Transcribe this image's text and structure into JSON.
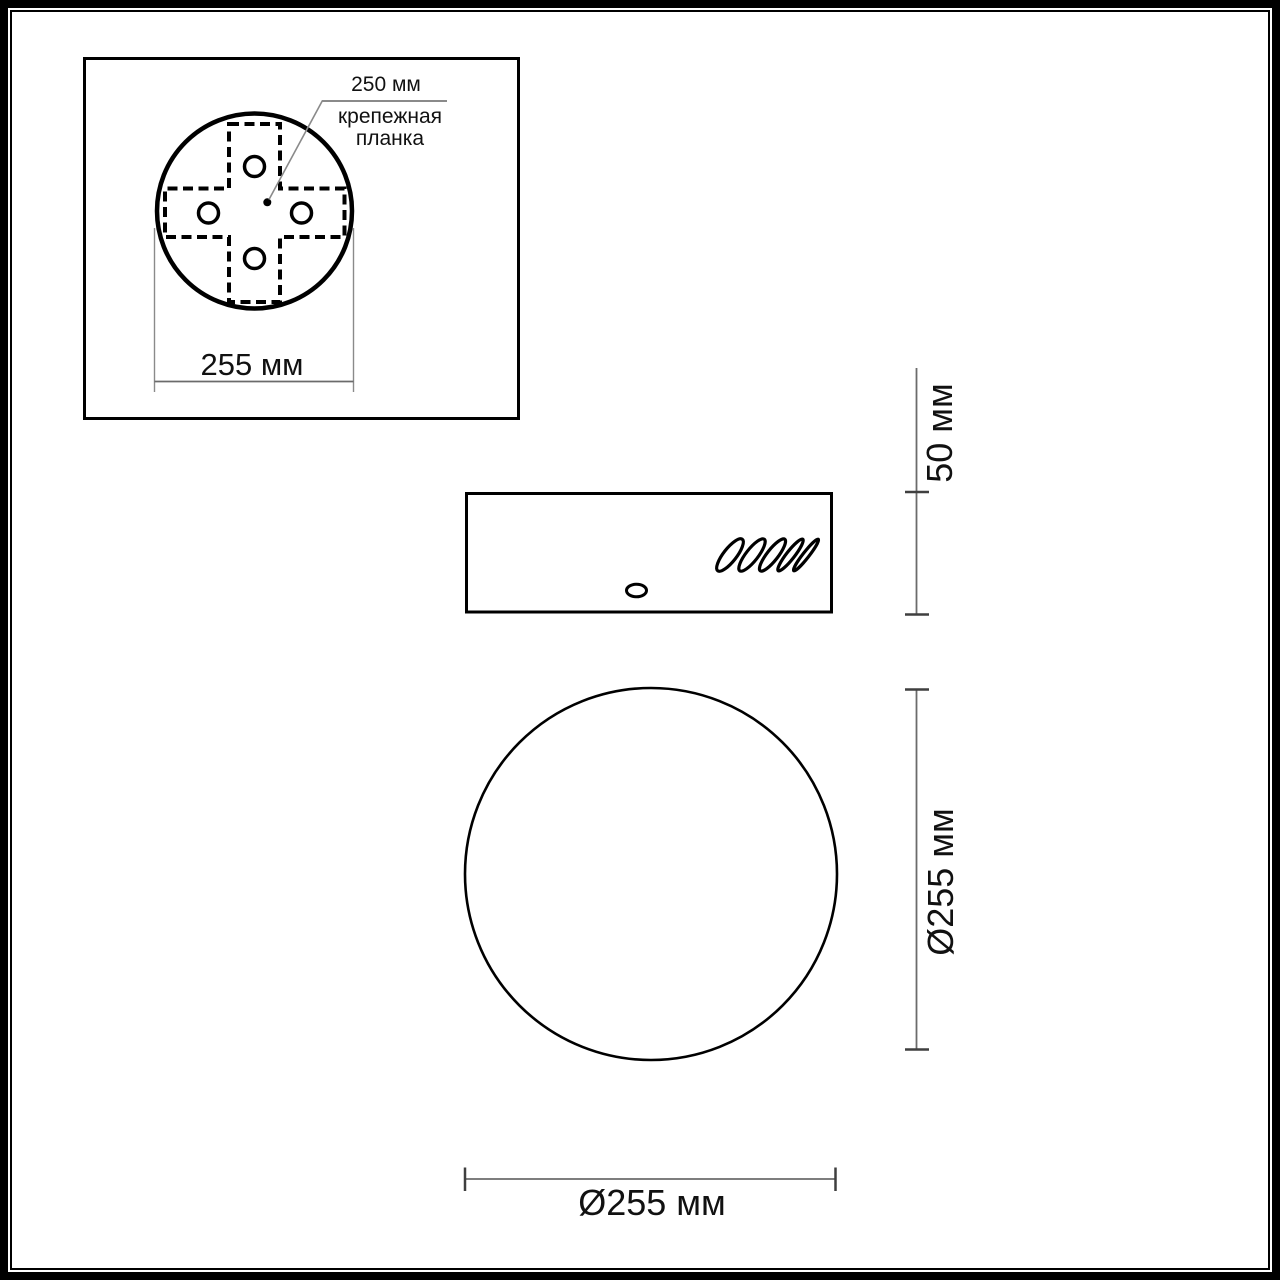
{
  "detail_view": {
    "hole_pitch_label": "250 мм",
    "bracket_label_line1": "крепежная",
    "bracket_label_line2": "планка",
    "width_label": "255 мм"
  },
  "side_view": {
    "height_label": "50 мм"
  },
  "front_view": {
    "diameter_label_side": "Ø255 мм",
    "diameter_label_bottom": "Ø255 мм"
  },
  "colors": {
    "shape_line": "#000000",
    "dimension_line": "#6b6b6b",
    "extension_line": "#8a8a8a",
    "tick": "#3f3f3f",
    "background": "#ffffff",
    "text": "#111111"
  }
}
